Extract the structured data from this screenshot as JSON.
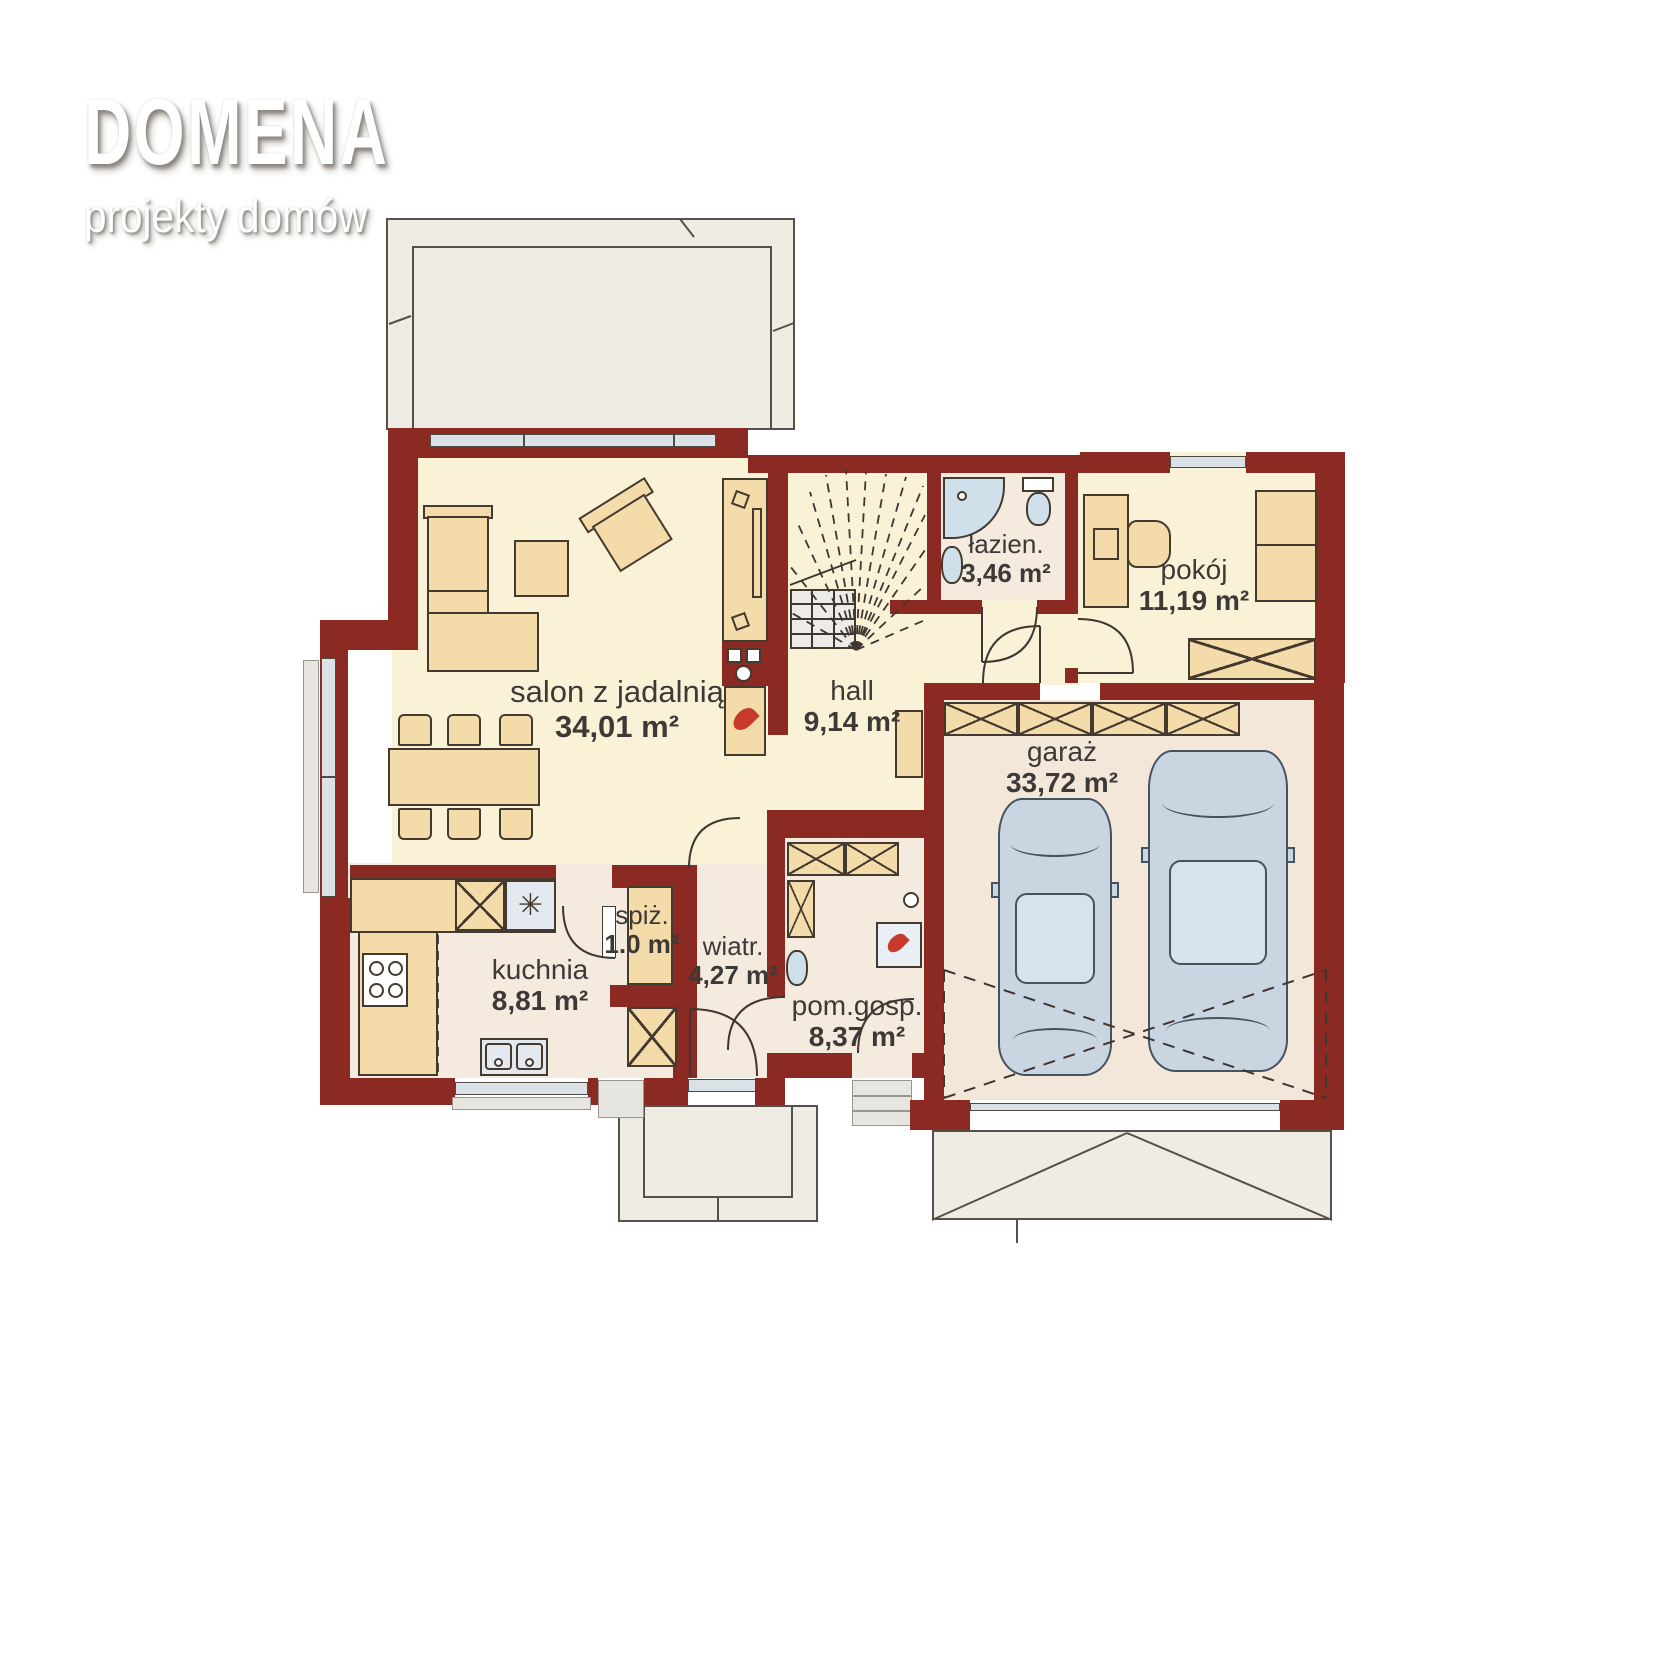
{
  "brand": {
    "title": "DOMENA",
    "subtitle": "projekty domów"
  },
  "rooms": {
    "salon": {
      "name": "salon z jadalnią",
      "area": "34,01 m²"
    },
    "hall": {
      "name": "hall",
      "area": "9,14 m²"
    },
    "lazienka": {
      "name": "łazien.",
      "area": "3,46 m²"
    },
    "pokoj": {
      "name": "pokój",
      "area": "11,19 m²"
    },
    "garaz": {
      "name": "garaż",
      "area": "33,72 m²"
    },
    "kuchnia": {
      "name": "kuchnia",
      "area": "8,81 m²"
    },
    "spizarnia": {
      "name": "spiż.",
      "area": "1.0 m²"
    },
    "wiatrolap": {
      "name": "wiatr.",
      "area": "4,27 m²"
    },
    "pomgosp": {
      "name": "pom.gosp.",
      "area": "8,37 m²"
    }
  },
  "icons": {
    "sink_asterisk": "✳"
  },
  "colors": {
    "wall": "#8B2A22",
    "floor_warm": "#FAF2D7",
    "floor_pink": "#F5EADE",
    "floor_garage": "#F3E7DA",
    "furniture": "#F3DCA9",
    "fixture_blue": "#CFE0EB",
    "terrace": "#EFECE4",
    "flame": "#C6392B",
    "label_text": "#3D3936"
  }
}
